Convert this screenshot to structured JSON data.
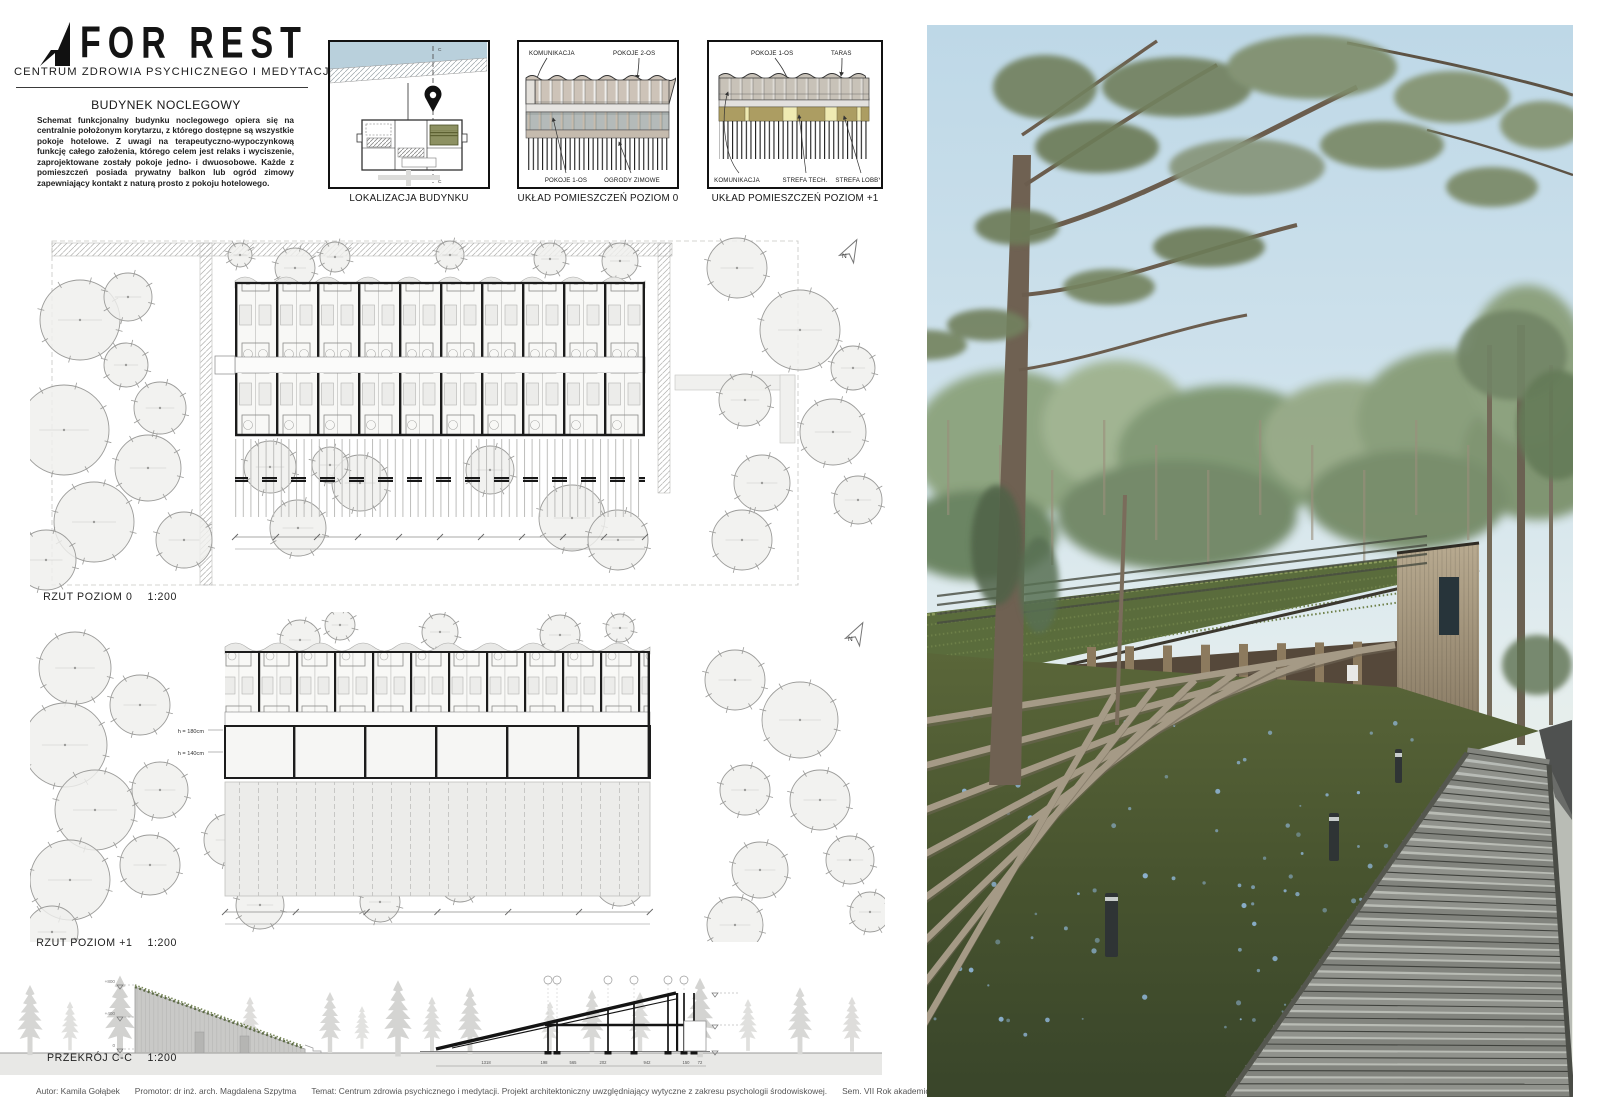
{
  "header": {
    "logo": "FOR REST",
    "subtitle": "CENTRUM ZDROWIA PSYCHICZNEGO I MEDYTACJI"
  },
  "intro": {
    "title": "BUDYNEK NOCLEGOWY",
    "body": "Schemat funkcjonalny budynku noclegowego opiera się na centralnie położonym korytarzu, z którego dostępne są wszystkie pokoje hotelowe. Z uwagi na terapeutyczno-wypoczynkową funkcję całego założenia, którego celem jest relaks i wyciszenie, zaprojektowane zostały pokoje jedno- i dwuosobowe. Każde z pomieszczeń posiada prywatny balkon lub ogród zimowy zapewniający kontakt z naturą prosto z pokoju hotelowego."
  },
  "diagram1": {
    "caption": "LOKALIZACJA BUDYNKU",
    "section_mark": "C"
  },
  "diagram2": {
    "caption": "UKŁAD POMIESZCZEŃ POZIOM 0",
    "label_komunikacja": "KOMUNIKACJA",
    "label_pokoje2": "POKOJE 2-OS",
    "label_pokoje1": "POKOJE 1-OS",
    "label_ogrody": "OGRODY ZIMOWE"
  },
  "diagram3": {
    "caption": "UKŁAD POMIESZCZEŃ POZIOM +1",
    "label_pokoje1": "POKOJE 1-OS",
    "label_taras": "TARAS",
    "label_komunikacja": "KOMUNIKACJA",
    "label_strefa_tech": "STREFA TECH.",
    "label_strefa_lobby": "STREFA LOBBY"
  },
  "plans": {
    "north": "N",
    "plan0": {
      "name": "RZUT POZIOM 0",
      "scale": "1:200"
    },
    "plan1": {
      "name": "RZUT POZIOM +1",
      "scale": "1:200",
      "h_upper": "h = 180cm",
      "h_lower": "h = 140cm"
    },
    "section": {
      "name": "PRZEKRÓJ  C-C",
      "scale": "1:200",
      "levels": [
        "+800",
        "+400",
        "0"
      ],
      "dims": [
        "1318",
        "198",
        "565",
        "202",
        "942",
        "150",
        "72"
      ]
    }
  },
  "footer": {
    "parts": [
      "Autor: Kamila Gołąbek",
      "Promotor: dr inż. arch. Magdalena Szpytma",
      "Temat: Centrum zdrowia psychicznego i medytacji. Projekt architektoniczny uwzględniający wytyczne z zakresu psychologii środowiskowej.",
      "Sem. VII  Rok akademicki 2020/21",
      "Politechnika Rzeszowska  Plansza 5"
    ]
  },
  "colors": {
    "highlight_olive": "#8d9162",
    "water_blue": "#b9d0dc",
    "khaki": "#ac9d62",
    "pale_yellow": "#efeab2",
    "room_tan": "#cdc3b8",
    "room_gray": "#b4bab9",
    "roof_green": "#5a6c3c",
    "grass_dark": "#46512f",
    "flower_blue": "#8fb6d8"
  }
}
